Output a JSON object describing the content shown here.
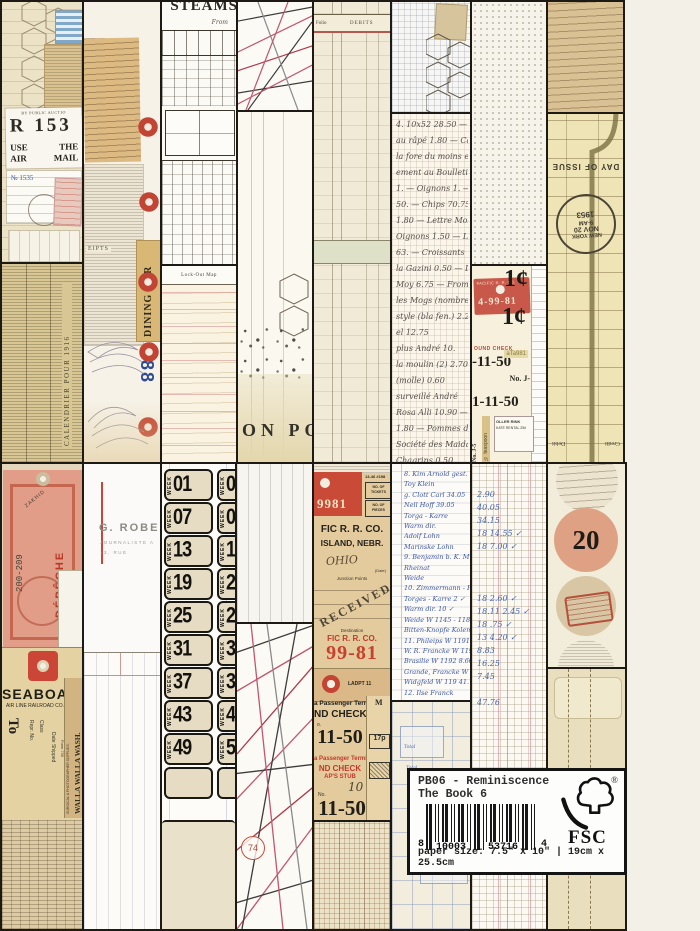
{
  "product_box": {
    "title_line1": "PB06 - Reminiscence",
    "title_line2": "The Book 6",
    "barcode_digit_left": "8",
    "barcode_group1": "10003",
    "barcode_group2": "53716",
    "barcode_digit_right": "4",
    "fsc_text": "FSC",
    "registered_mark": "®",
    "paper_size_text": "paper size: 7.5\" x 10\" | 19cm x 25.5cm"
  },
  "collage": {
    "mail_tile": {
      "auction_line": "BY PUBLIC AUCTIO",
      "registered_r": "R 153",
      "use": "USE",
      "the": "THE",
      "air": "AIR",
      "mail": "MAIL",
      "reg_number": "№ 1535"
    },
    "almanac": {
      "side_caption": "CALENDRIER POUR 1916"
    },
    "sketch_tile": {
      "dining_car": "DINING CAR",
      "double_eight": "88",
      "receipts": "EIPTS"
    },
    "steamship": {
      "title": "STEAMS",
      "from_label": "From"
    },
    "pink_ledger": {
      "header": "Lock-Out Map"
    },
    "folio_ledger": {
      "folio": "Folio",
      "debits": "DEBITS"
    },
    "on_post": {
      "text": "ON  POS"
    },
    "french_lines": [
      "4. 10x52  28.50 — Pann",
      "au râpé  1.80 — Camem",
      "la fore du moins et mag",
      "ement au Boulletin de",
      "1. — Oignons 1. — Sala",
      "50. — Chips  70.75 — L",
      "1.80 — Lettre Mozy  4.20",
      "Oignons 1.50 — Lucas",
      "63. — Croissants",
      "la Gazini 0.50 — Dra",
      "Moy 6.75 — Fromage",
      "les Mogs (nombreux)",
      "style (bla fen.)  2.25",
      "el  12.75",
      "plus André  10.",
      "la moulin (2)  2.70",
      "(molle)  0.60",
      "surveillé André",
      "Rosa Alli  10.90 —",
      "1.80 — Pommes de terre",
      "Société des Maidan",
      "Chagrins  0.50"
    ],
    "library_card": {
      "day_of_issue": "DAY OF ISSUE",
      "postmark_top": "NEW YORK",
      "postmark_mid": "NOV 20",
      "postmark_mid2": "9-AM",
      "postmark_year": "1953",
      "credit": "Credit",
      "debit": "Debit"
    },
    "penny_tile": {
      "cent_top": "1¢",
      "cent_bottom": "1¢",
      "red_ticket_header": "PACIFIC R. R. CO.",
      "red_ticket_number": "4-99-81",
      "round_check": "OUND CHECK",
      "check_number_top": "-11-50",
      "check_number_bottom": "1-11-50",
      "tag_code": "aTa981",
      "no_j": "No. J-",
      "roller_rink": "OLLER RINK",
      "skate_rental": "KATE RENTAL 25¢",
      "teaspoon": "½ teaspoon",
      "no_j5": "No. J-5"
    },
    "week_tile": {
      "week_label": "WEEK",
      "rows": [
        {
          "left": "01",
          "right": "02"
        },
        {
          "left": "07",
          "right": "08"
        },
        {
          "left": "13",
          "right": "14"
        },
        {
          "left": "19",
          "right": "20"
        },
        {
          "left": "25",
          "right": "26"
        },
        {
          "left": "31",
          "right": "32"
        },
        {
          "left": "37",
          "right": "38"
        },
        {
          "left": "43",
          "right": "44"
        },
        {
          "left": "49",
          "right": "50"
        }
      ]
    },
    "journalist_card": {
      "name": "G. ROBERT",
      "line2": "JOURNALISTE A",
      "line3": "13, RUE"
    },
    "tags_tile": {
      "depeche": "DÉPÊCHE",
      "range_number": "200-209",
      "zakhid": "ZAKHID",
      "seaboard": "SEABOARD",
      "airline": "AIR LINE RAILROAD CO.",
      "to_label": "To",
      "repr_label": "Repr. No.",
      "class_label": "Class",
      "date_shipped": "Date Shipped",
      "form_number": "Form 730",
      "supplies": "SURGICAL & PHOTOGRAPHER SUPPLIES,",
      "walla": "WALLA WALLA WASH."
    },
    "rr_ticket": {
      "stub_number": "9981",
      "code_line": "13-46  #198",
      "no_of_tickets": "NO. OF TICKETS",
      "no_of_pieces": "NO. OF PIECES",
      "company": "FIC R. R. CO.",
      "city": "ISLAND, NEBR.",
      "ohio": "OHIO",
      "date_label": "(Date)",
      "junction": "Junction Points",
      "received_stamp": "RECEIVED",
      "destination": "Destination",
      "company2": "FIC R. R. CO.",
      "red_number": "99-81",
      "ladpt": "LADPT 11",
      "terminal_black": "a Passenger Terminal",
      "check_black": "ND CHECK",
      "small_no": "o.",
      "big_number1": "11-50",
      "terminal_red": "a Passenger Terminal",
      "check_red": "ND CHECK",
      "stub_red": "AP'S STUB",
      "script_number": "10",
      "no_label": "No.",
      "big_number2": "11-50",
      "pence_box": "17p",
      "m_label": "M"
    },
    "blue_list_lines": [
      "8.  Kim Arnold   gest.  14.05",
      "Toy   Klein",
      "g. Clott   Carl   34.05",
      "Nell Hoff   39.05",
      "Torga - Karre",
      "Warm  dir.",
      "Adolf  Lohn",
      "Marinske  Lohn",
      "9.  Benjamin   b. K. M.",
      "Rheinat",
      "Weide",
      "10.  Zimmermann - Potsdam",
      "Torges - Karre   2 ✓",
      "Warm  dir.   10 ✓",
      "Weide  W 1145 - 1182   4",
      "Bitten-Knopfe  Kolemann",
      "11.  Phileips   W 1191   14.05 ✓",
      "W. R. Francke   W 1192   16.05",
      "Brasilie   W 1192   8.60 ✓",
      "Grande, Francke  W 1193",
      "Widgfeld   W 119   41.70",
      "12.  Ilse Franck"
    ],
    "numbers_column": [
      "2.90",
      "40.05",
      "34.15",
      "18    14.55 ✓",
      "18    7.00 ✓",
      "",
      "",
      "",
      "18    2.60 ✓",
      "18.11   2.45 ✓",
      "18    .75 ✓",
      "13    4.20 ✓",
      "8.83",
      "16.25",
      "7.45",
      "",
      "47.76"
    ],
    "blue_form": {
      "total_label": "Total"
    },
    "string_tile": {
      "circle_number": "74"
    },
    "twenty_tile": {
      "number": "20"
    }
  }
}
